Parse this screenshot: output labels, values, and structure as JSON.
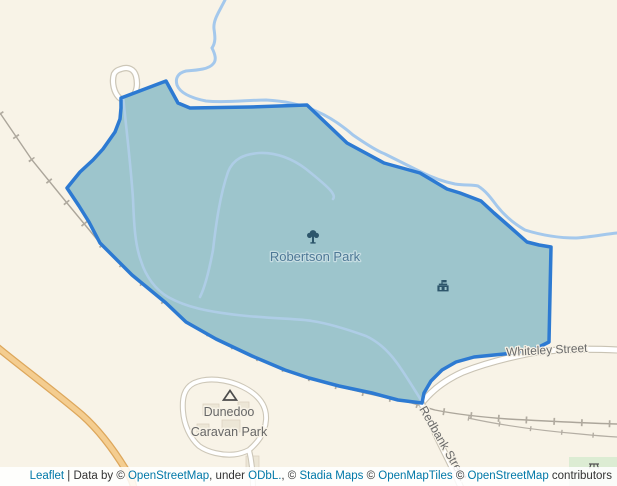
{
  "map": {
    "labels": {
      "park": "Robertson Park",
      "street_whiteley": "Whiteley Street",
      "street_redbank": "Redbank Street",
      "caravan_line1": "Dunedoo",
      "caravan_line2": "Caravan Park"
    },
    "icons": {
      "park_poi": "tree-icon",
      "fort_poi": "fort-icon",
      "campsite_poi": "campsite-icon",
      "picnic_poi": "picnic-table-icon"
    },
    "colors": {
      "land": "#f8f3e7",
      "park_fill": "#9dc5cc",
      "park_border": "#2d7ad2",
      "stream": "#a4c8ec",
      "inner_path": "#aecde6",
      "road_white": "#ffffff",
      "road_casing": "#cdc7b8",
      "road_orange_fill": "#f4cd90",
      "road_orange_casing": "#dda75c",
      "railway": "#aca69b",
      "green_area": "#dcecd3",
      "street_label": "#6a6a6a",
      "park_label": "#4e7896",
      "poi_icon": "#2d566b",
      "link": "#0078a8"
    }
  },
  "attribution": {
    "parts": [
      {
        "text": "Leaflet",
        "link": true
      },
      {
        "text": " | Data by © ",
        "link": false
      },
      {
        "text": "OpenStreetMap",
        "link": true
      },
      {
        "text": ", under ",
        "link": false
      },
      {
        "text": "ODbL.",
        "link": true
      },
      {
        "text": ", © ",
        "link": false
      },
      {
        "text": "Stadia Maps",
        "link": true
      },
      {
        "text": " © ",
        "link": false
      },
      {
        "text": "OpenMapTiles",
        "link": true
      },
      {
        "text": " © ",
        "link": false
      },
      {
        "text": "OpenStreetMap",
        "link": true
      },
      {
        "text": " contributors",
        "link": false
      }
    ]
  }
}
